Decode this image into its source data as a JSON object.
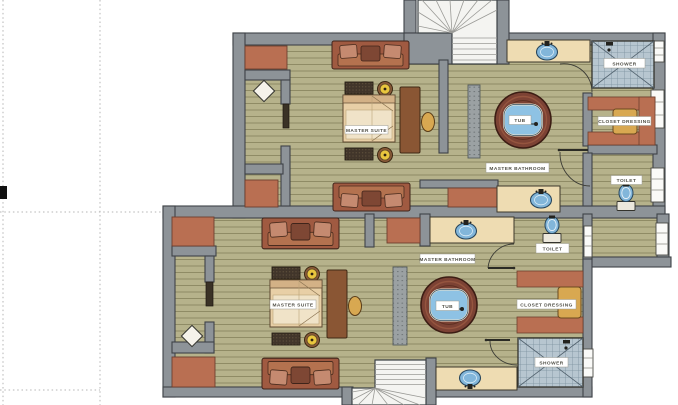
{
  "document": {
    "type": "floor-plan",
    "title": "Master suites floor plan"
  },
  "palette": {
    "wall": "#8d9398",
    "wall_stroke": "#3e4347",
    "floor": "#b6b28b",
    "floor_line": "#8f8b65",
    "rug_terracotta": "#b96f52",
    "sofa_frame": "#a05a41",
    "sofa_pillow": "#c58a70",
    "sofa_cushion_dark": "#7e4734",
    "bed_body": "#e8cfa6",
    "counter": "#eedcb2",
    "water_blue": "#82b6da",
    "tile": "#b7c6d0",
    "tub_wood": "#7c4234",
    "wardrobe_tan": "#d8a851",
    "lamp_yellow": "#e9c63e",
    "stair": "#f4f4f1",
    "label_bg": "#ffffff",
    "label_text": "#4f4e45",
    "guide_dotted": "#b5b5b5",
    "crop_mark": "#111111"
  },
  "units": [
    {
      "name": "upper-suite",
      "labels": {
        "suite": "MASTER SUITE",
        "bathroom": "MASTER BATHROOM",
        "tub": "TUB",
        "shower": "SHOWER",
        "closet": "CLOSET DRESSING",
        "toilet": "TOILET"
      }
    },
    {
      "name": "lower-suite",
      "labels": {
        "suite": "MASTER SUITE",
        "bathroom": "MASTER BATHROOM",
        "tub": "TUB",
        "shower": "SHOWER",
        "closet": "CLOSET DRESSING",
        "toilet": "TOILET"
      }
    }
  ]
}
